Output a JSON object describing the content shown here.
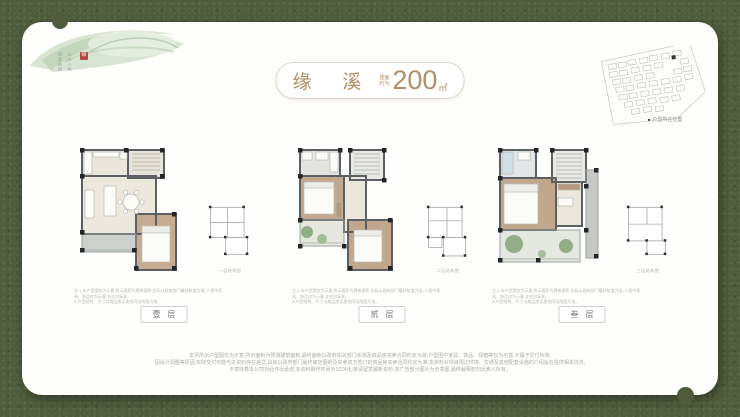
{
  "colors": {
    "frame_green": "#4e5b3c",
    "card_white": "#fefefc",
    "accent_bronze": "#b28f63",
    "seal_red": "#b04a3e"
  },
  "brand": {
    "vertical_text_col1": "缘溪而居",
    "vertical_text_col2": "山水入画",
    "seal_char": "缘"
  },
  "title": {
    "name": "缘 溪",
    "area_note_line1": "建面",
    "area_note_line2": "约为",
    "area_value": "200",
    "area_unit": "㎡"
  },
  "siteplan": {
    "legend_marker": "■",
    "legend_text": "户型所在位置"
  },
  "floors": [
    {
      "caption": "壹层",
      "mini_caption": "一层结构图",
      "note_line1": "注:1.本户型图仅为示意,所示面积为建筑面积,实际以政府部门最终核准为准; 2.图中家具、饰品仅为示意,非交付标准;",
      "note_line2": "3.户型结构、尺寸以商品房买卖合同及附图为准。"
    },
    {
      "caption": "贰层",
      "mini_caption": "二层结构图",
      "note_line1": "注:1.本户型图仅为示意,所示面积为建筑面积,实际以政府部门最终核准为准; 2.图中家具、饰品仅为示意,非交付标准;",
      "note_line2": "3.户型结构、尺寸以商品房买卖合同及附图为准。"
    },
    {
      "caption": "叁层",
      "mini_caption": "三层结构图",
      "note_line1": "注:1.本户型图仅为示意,所示面积为建筑面积,实际以政府部门最终核准为准; 2.图中家具、饰品仅为示意,非交付标准;",
      "note_line2": "3.户型结构、尺寸以商品房买卖合同及附图为准。"
    }
  ],
  "disclaimer": {
    "line1": "本页所示户型图仅为示意,所示面积为预测建筑面积,最终面积以政府相关部门实测及商品房买卖合同约定为准;户型图中家具、饰品、绿植等仅为示意,不属于交付标准;",
    "line2": "因设计调整等原因,实际交付可能与本资料存在差异,具体以政府部门最终审定图纸及买卖双方签订的商品房买卖合同约定为准;本资料对项目周边环境、交通及其他配套设施的介绍旨在提供相关信息,",
    "line3": "不意味着本公司对此作出承诺;本资料制作时间为2024年,敬请留意最新资料;本广告部分图片为示意图,最终解释权归出卖人所有。"
  }
}
